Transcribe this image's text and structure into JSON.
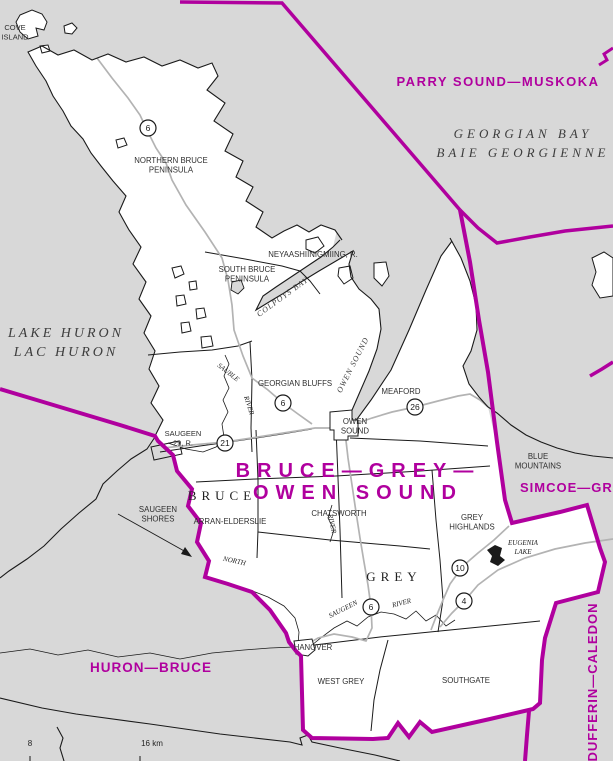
{
  "map": {
    "district_title": "BRUCE—GREY—OWEN SOUND",
    "colors": {
      "boundary_magenta": "#b0009e",
      "water_gray": "#d8d8d8",
      "land_white": "#ffffff",
      "road_gray": "#b3b3b3",
      "line_black": "#1a1a1a"
    },
    "labels": [
      {
        "name": "label-parry-sound-muskoka",
        "type": "district",
        "text": "PARRY SOUND—MUSKOKA",
        "x": 498,
        "y": 86,
        "size": 13,
        "ls": 1.5
      },
      {
        "name": "label-district-title",
        "type": "district-title",
        "lines": [
          "BRUCE—GREY—",
          "OWEN SOUND"
        ],
        "x": 358,
        "y": 477,
        "size": 20,
        "ls": 7,
        "lh": 22
      },
      {
        "name": "label-huron-bruce",
        "type": "district",
        "text": "HURON—BRUCE",
        "x": 151,
        "y": 672,
        "size": 13.5,
        "ls": 1
      },
      {
        "name": "label-simcoe-grey",
        "type": "district",
        "text": "SIMCOE—GREY",
        "x": 520,
        "y": 492,
        "size": 13,
        "ls": 1,
        "anchor": "start"
      },
      {
        "name": "label-dufferin-caledon",
        "type": "district",
        "text": "DUFFERIN—CALEDON",
        "x": 597,
        "y": 682,
        "size": 13,
        "ls": 1,
        "rotate": -90
      },
      {
        "name": "label-georgian-bay",
        "type": "water",
        "lines": [
          "GEORGIAN BAY",
          "BAIE GEORGIENNE"
        ],
        "x": 523,
        "y": 138,
        "size": 13,
        "ls": 4,
        "lh": 19
      },
      {
        "name": "label-lake-huron",
        "type": "water",
        "lines": [
          "LAKE HURON",
          "LAC HURON"
        ],
        "x": 66,
        "y": 337,
        "size": 14,
        "ls": 3,
        "lh": 19
      },
      {
        "name": "label-colpoys-bay",
        "type": "water-small",
        "text": "COLPOYS BAY",
        "x": 284,
        "y": 299,
        "size": 8,
        "ls": 1,
        "rotate": -36
      },
      {
        "name": "label-owen-sound-water",
        "type": "water-small",
        "text": "OWEN SOUND",
        "x": 355,
        "y": 366,
        "size": 8,
        "ls": 1,
        "rotate": -63
      },
      {
        "name": "label-bruce-county",
        "type": "county",
        "text": "BRUCE",
        "x": 222,
        "y": 500,
        "size": 13,
        "ls": 5
      },
      {
        "name": "label-grey-county",
        "type": "county",
        "text": "GREY",
        "x": 394,
        "y": 581,
        "size": 13,
        "ls": 5
      },
      {
        "name": "label-cove-island",
        "type": "muni",
        "lines": [
          "COVE",
          "ISLAND"
        ],
        "x": 15,
        "y": 30,
        "size": 7.5,
        "lh": 9.5
      },
      {
        "name": "label-northern-bruce-peninsula",
        "type": "muni",
        "lines": [
          "NORTHERN BRUCE",
          "PENINSULA"
        ],
        "x": 171,
        "y": 163,
        "size": 7.8,
        "lh": 9.5
      },
      {
        "name": "label-south-bruce-peninsula",
        "type": "muni",
        "lines": [
          "SOUTH BRUCE",
          "PENINSULA"
        ],
        "x": 247,
        "y": 272,
        "size": 7.8,
        "lh": 9.5
      },
      {
        "name": "label-neyaashiinigmiing",
        "type": "muni",
        "text": "NEYAASHIINIGMIING, R.",
        "x": 313,
        "y": 257,
        "size": 7.8
      },
      {
        "name": "label-georgian-bluffs",
        "type": "muni",
        "text": "GEORGIAN BLUFFS",
        "x": 295,
        "y": 386,
        "size": 7.8
      },
      {
        "name": "label-meaford",
        "type": "muni",
        "text": "MEAFORD",
        "x": 401,
        "y": 394,
        "size": 7.8
      },
      {
        "name": "label-owen-sound-town",
        "type": "muni",
        "lines": [
          "OWEN",
          "SOUND"
        ],
        "x": 355,
        "y": 424,
        "size": 7.8,
        "lh": 9.5
      },
      {
        "name": "label-saugeen-29",
        "type": "muni",
        "lines": [
          "SAUGEEN",
          "29, R."
        ],
        "x": 183,
        "y": 436,
        "size": 7.5,
        "lh": 9.5
      },
      {
        "name": "label-saugeen-shores",
        "type": "muni",
        "lines": [
          "SAUGEEN",
          "SHORES"
        ],
        "x": 158,
        "y": 512,
        "size": 7.8,
        "lh": 9.5
      },
      {
        "name": "label-arran-elderslie",
        "type": "muni",
        "text": "ARRAN-ELDERSLIE",
        "x": 230,
        "y": 524,
        "size": 7.8
      },
      {
        "name": "label-chatsworth",
        "type": "muni",
        "text": "CHATSWORTH",
        "x": 339,
        "y": 516,
        "size": 7.8
      },
      {
        "name": "label-grey-highlands",
        "type": "muni",
        "lines": [
          "GREY",
          "HIGHLANDS"
        ],
        "x": 472,
        "y": 520,
        "size": 7.8,
        "lh": 9.5
      },
      {
        "name": "label-blue-mountains",
        "type": "muni",
        "lines": [
          "BLUE",
          "MOUNTAINS"
        ],
        "x": 538,
        "y": 459,
        "size": 7.8,
        "lh": 9.5
      },
      {
        "name": "label-hanover",
        "type": "muni",
        "text": "HANOVER",
        "x": 313,
        "y": 650,
        "size": 7.8
      },
      {
        "name": "label-west-grey",
        "type": "muni",
        "text": "WEST  GREY",
        "x": 341,
        "y": 684,
        "size": 7.8
      },
      {
        "name": "label-southgate",
        "type": "muni",
        "text": "SOUTHGATE",
        "x": 466,
        "y": 683,
        "size": 7.8
      },
      {
        "name": "label-eugenia-lake",
        "type": "lake",
        "lines": [
          "EUGENIA",
          "LAKE"
        ],
        "x": 523,
        "y": 545,
        "size": 7,
        "lh": 9
      },
      {
        "name": "label-sauble",
        "type": "river",
        "text": "SAUBLE",
        "x": 227,
        "y": 374,
        "size": 7,
        "rotate": 38
      },
      {
        "name": "label-sauble-river",
        "type": "river",
        "text": "RIVER",
        "x": 247,
        "y": 406,
        "size": 7,
        "rotate": 72
      },
      {
        "name": "label-north-saugeen",
        "type": "river",
        "text": "NORTH",
        "x": 234,
        "y": 563,
        "size": 7,
        "rotate": 12
      },
      {
        "name": "label-river-mid",
        "type": "river",
        "text": "RIVER",
        "x": 330,
        "y": 524,
        "size": 7,
        "rotate": 78
      },
      {
        "name": "label-saugeen-river-1",
        "type": "river",
        "text": "SAUGEEN",
        "x": 344,
        "y": 611,
        "size": 7,
        "rotate": -27
      },
      {
        "name": "label-saugeen-river-2",
        "type": "river",
        "text": "RIVER",
        "x": 402,
        "y": 605,
        "size": 7,
        "rotate": -14
      },
      {
        "name": "label-scale-8",
        "type": "scale",
        "text": "8",
        "x": 30,
        "y": 746,
        "size": 8
      },
      {
        "name": "label-scale-16km",
        "type": "scale",
        "text": "16 km",
        "x": 152,
        "y": 746,
        "size": 8
      }
    ],
    "highway_shields": [
      {
        "number": "6",
        "x": 148,
        "y": 128
      },
      {
        "number": "6",
        "x": 283,
        "y": 403
      },
      {
        "number": "21",
        "x": 225,
        "y": 443
      },
      {
        "number": "26",
        "x": 415,
        "y": 407
      },
      {
        "number": "6",
        "x": 371,
        "y": 607
      },
      {
        "number": "10",
        "x": 460,
        "y": 568
      },
      {
        "number": "4",
        "x": 464,
        "y": 601
      }
    ]
  }
}
